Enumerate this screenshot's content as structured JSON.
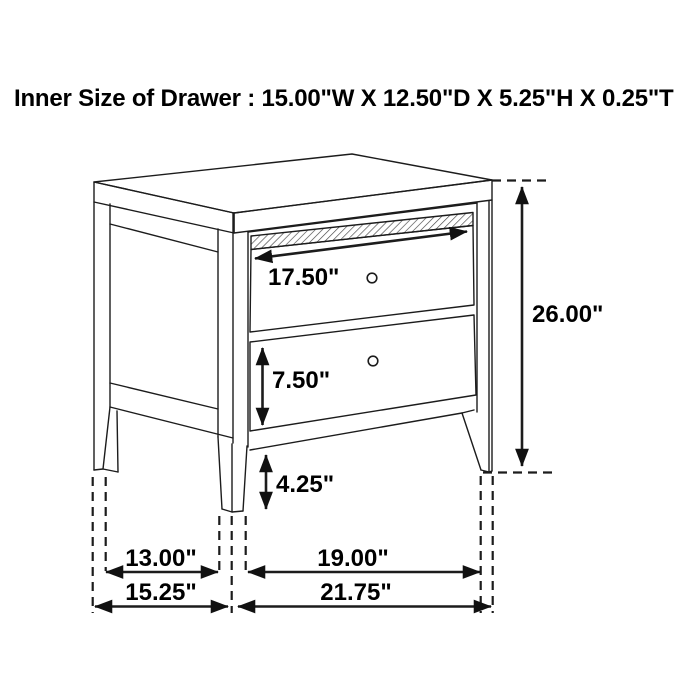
{
  "header": {
    "title": "Inner Size of Drawer : 15.00\"W X 12.50\"D X 5.25\"H X 0.25\"T",
    "inner_drawer": {
      "width": "15.00\"W",
      "depth": "12.50\"D",
      "height": "5.25\"H",
      "thickness": "0.25\"T"
    }
  },
  "diagram": {
    "subject": "two-drawer nightstand line drawing with dimension arrows",
    "dims": {
      "top_drawer_width": {
        "label": "17.50\"",
        "value": 17.5
      },
      "overall_height": {
        "label": "26.00\"",
        "value": 26.0
      },
      "drawer_front_height": {
        "label": "7.50\"",
        "value": 7.5
      },
      "leg_height": {
        "label": "4.25\"",
        "value": 4.25
      },
      "leg_span_side": {
        "label": "13.00\"",
        "value": 13.0
      },
      "leg_span_front": {
        "label": "19.00\"",
        "value": 19.0
      },
      "overall_depth": {
        "label": "15.25\"",
        "value": 15.25
      },
      "overall_width": {
        "label": "21.75\"",
        "value": 21.75
      }
    }
  },
  "colors": {
    "line": "#1c1c1c",
    "text": "#000000",
    "background": "#ffffff"
  }
}
